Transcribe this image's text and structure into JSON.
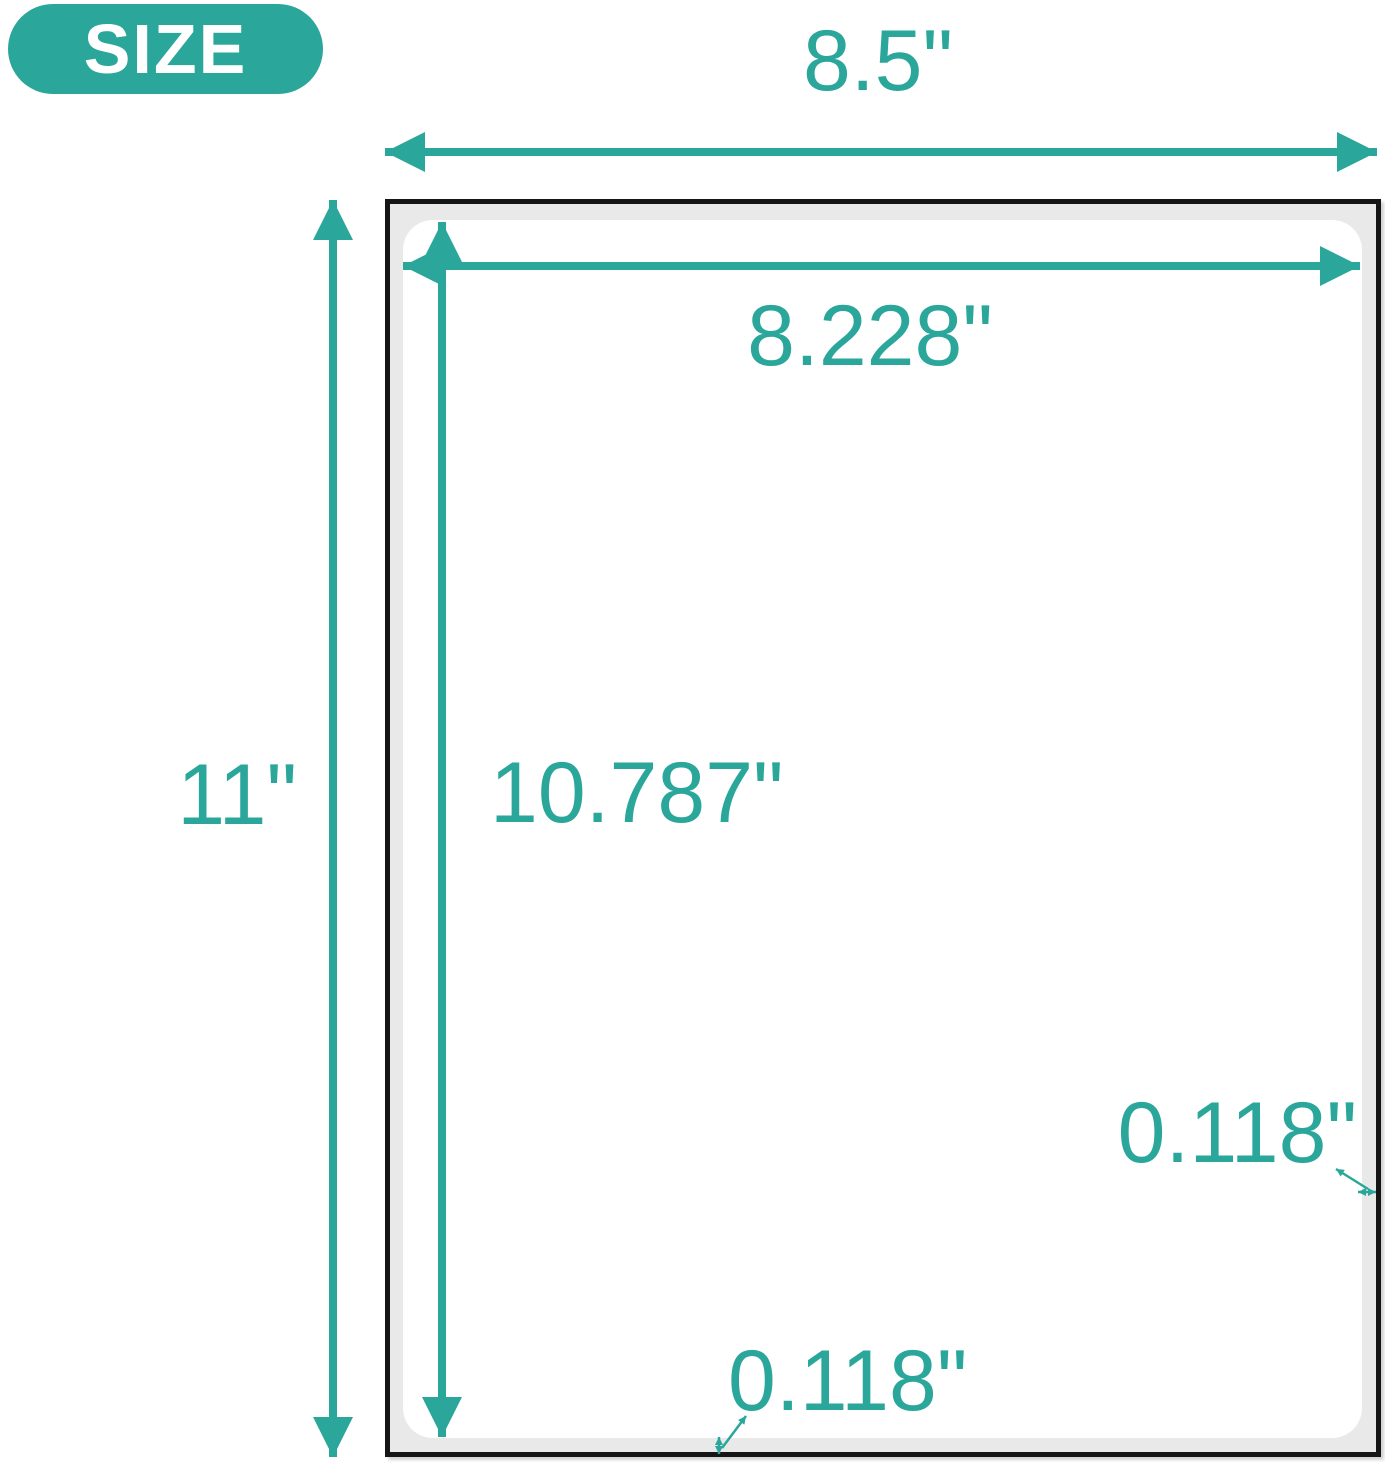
{
  "badge": {
    "label": "SIZE"
  },
  "diagram": {
    "sheet_width_label": "8.5\"",
    "sheet_height_label": "11\"",
    "print_area_width_label": "8.228\"",
    "print_area_height_label": "10.787\"",
    "right_margin_label": "0.118\"",
    "bottom_margin_label": "0.118\""
  },
  "colors": {
    "accent_teal": "#2aa79a",
    "sheet_border": "#151515",
    "sheet_margin_gray": "#e9e9e9",
    "label_area_white": "#ffffff",
    "badge_text": "#ffffff"
  }
}
